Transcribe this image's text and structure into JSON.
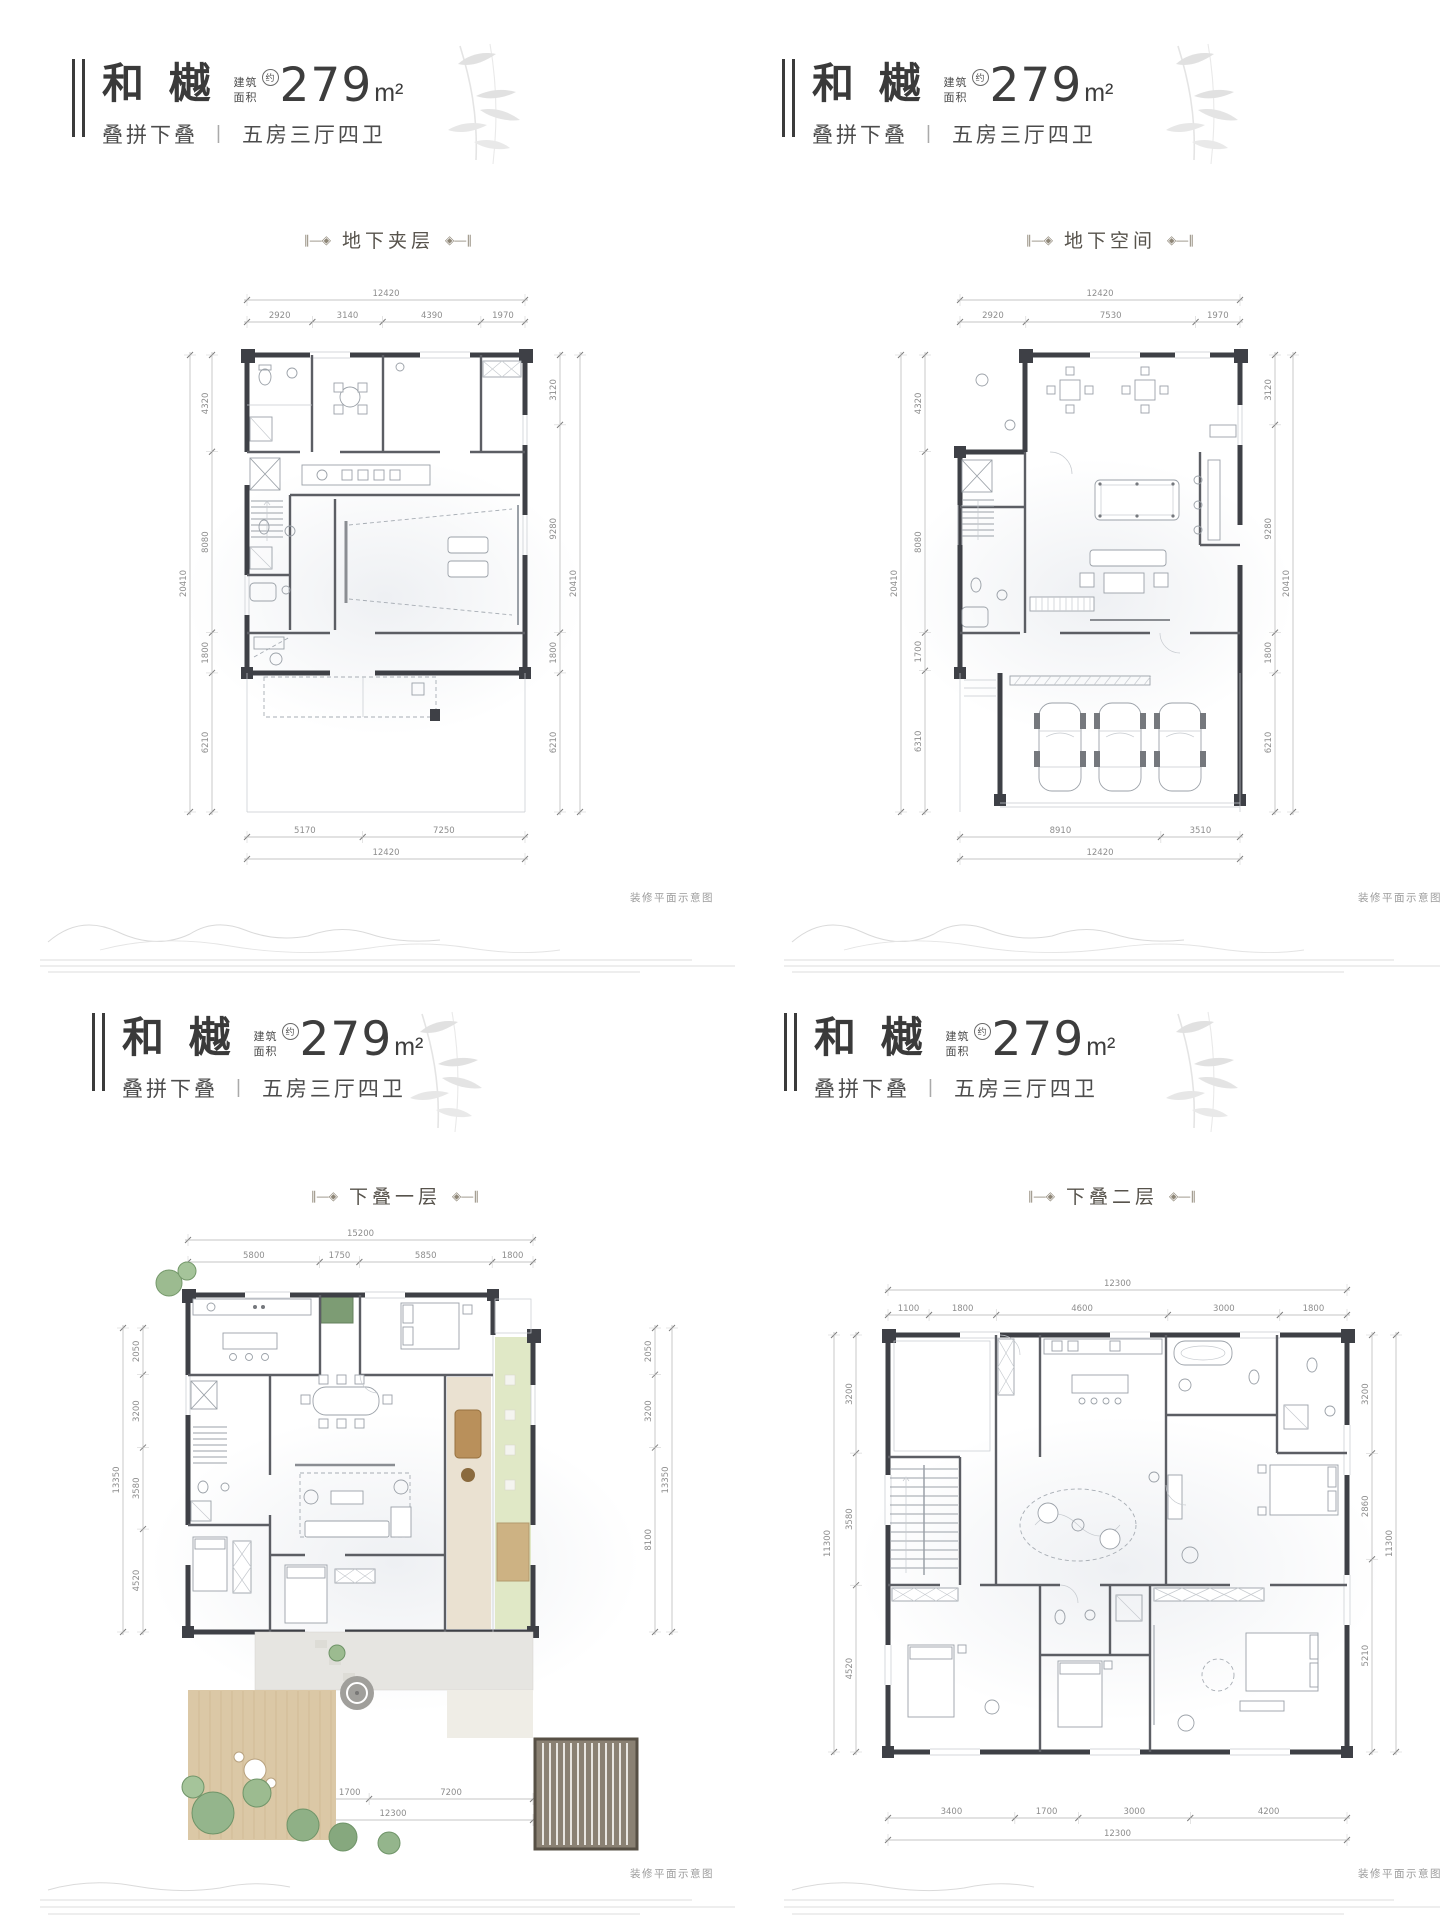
{
  "plans": [
    {
      "header": {
        "brand": "和 樾",
        "area_label1": "建筑",
        "area_label2": "面积",
        "approx": "约",
        "area": "279",
        "area_unit": "m²",
        "type": "叠拼下叠",
        "sep": "|",
        "rooms": "五房三厅四卫"
      },
      "title": "地下夹层",
      "ornament_left": "∥—◈",
      "ornament_right": "◈—∥",
      "note": "装修平面示意图",
      "dims": {
        "top_total": "12420",
        "top": [
          "2920",
          "3140",
          "4390",
          "1970"
        ],
        "left_total": "20410",
        "left": [
          "4320",
          "8080",
          "1800",
          "6210"
        ],
        "right_total": "20410",
        "right": [
          "3120",
          "9280",
          "1800",
          "6210"
        ],
        "bottom": [
          "5170",
          "7250"
        ],
        "bottom_total": "12420"
      }
    },
    {
      "header": {
        "brand": "和 樾",
        "area_label1": "建筑",
        "area_label2": "面积",
        "approx": "约",
        "area": "279",
        "area_unit": "m²",
        "type": "叠拼下叠",
        "sep": "|",
        "rooms": "五房三厅四卫"
      },
      "title": "地下空间",
      "ornament_left": "∥—◈",
      "ornament_right": "◈—∥",
      "note": "装修平面示意图",
      "dims": {
        "top_total": "12420",
        "top": [
          "2920",
          "7530",
          "1970"
        ],
        "left_total": "20410",
        "left": [
          "4320",
          "8080",
          "1700",
          "6310"
        ],
        "right_total": "20410",
        "right": [
          "3120",
          "9280",
          "1800",
          "6210"
        ],
        "bottom": [
          "8910",
          "3510"
        ],
        "bottom_total": "12420"
      }
    },
    {
      "header": {
        "brand": "和 樾",
        "area_label1": "建筑",
        "area_label2": "面积",
        "approx": "约",
        "area": "279",
        "area_unit": "m²",
        "type": "叠拼下叠",
        "sep": "|",
        "rooms": "五房三厅四卫"
      },
      "title": "下叠一层",
      "ornament_left": "∥—◈",
      "ornament_right": "◈—∥",
      "note": "装修平面示意图",
      "dims": {
        "top_total": "15200",
        "top": [
          "5800",
          "1750",
          "5850",
          "1800"
        ],
        "left_total": "13350",
        "left": [
          "2050",
          "3200",
          "3580",
          "4520"
        ],
        "right_total": "13350",
        "right": [
          "2050",
          "3200",
          "8100"
        ],
        "bottom": [
          "3400",
          "1700",
          "7200"
        ],
        "bottom_total": "12300"
      }
    },
    {
      "header": {
        "brand": "和 樾",
        "area_label1": "建筑",
        "area_label2": "面积",
        "approx": "约",
        "area": "279",
        "area_unit": "m²",
        "type": "叠拼下叠",
        "sep": "|",
        "rooms": "五房三厅四卫"
      },
      "title": "下叠二层",
      "ornament_left": "∥—◈",
      "ornament_right": "◈—∥",
      "note": "装修平面示意图",
      "dims": {
        "top_total": "12300",
        "top": [
          "1100",
          "1800",
          "4600",
          "3000",
          "1800"
        ],
        "left_total": "11300",
        "left": [
          "3200",
          "3580",
          "4520"
        ],
        "right_total": "11300",
        "right": [
          "3200",
          "2860",
          "5210"
        ],
        "bottom": [
          "3400",
          "1700",
          "3000",
          "4200"
        ],
        "bottom_total": "12300"
      }
    }
  ]
}
